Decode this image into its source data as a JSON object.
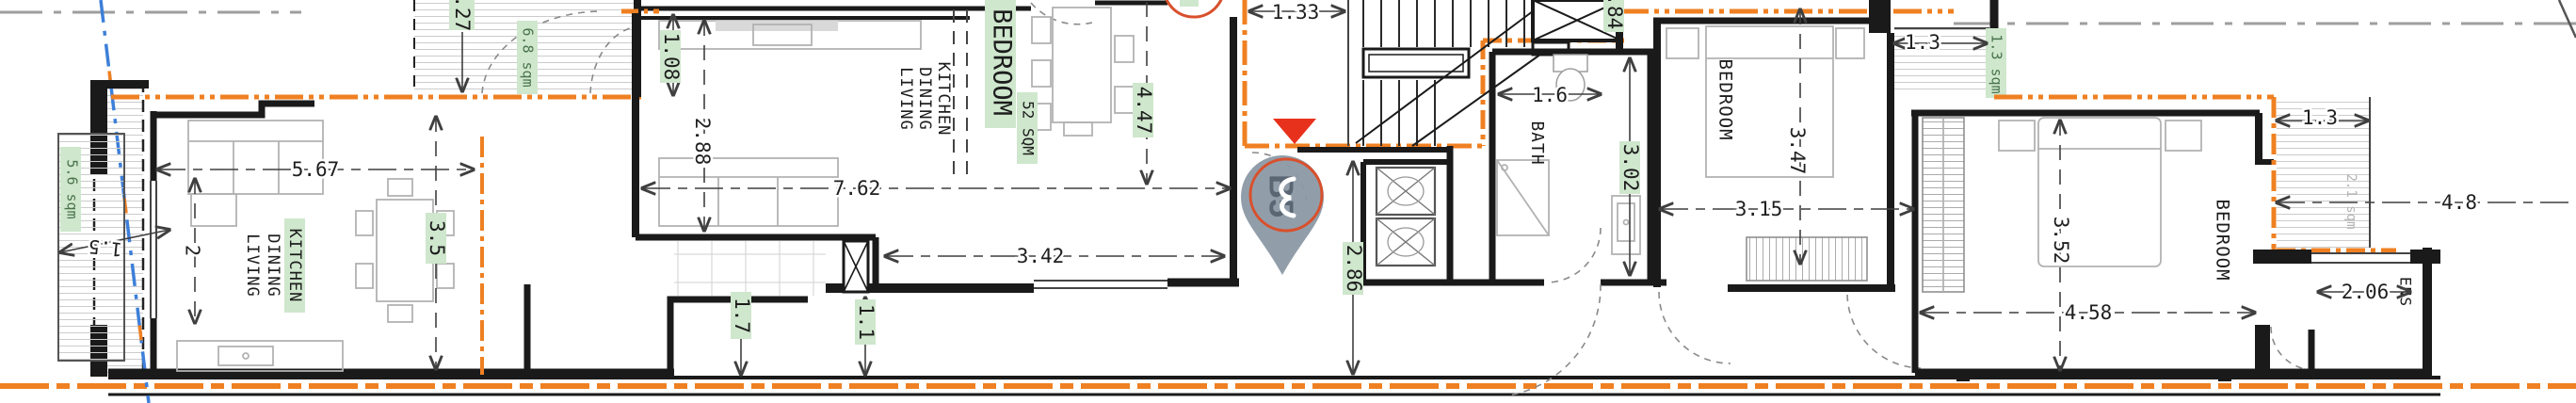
{
  "plan": {
    "pin_label": "B5",
    "rooms": {
      "u1_kitchen": "KITCHEN",
      "u1_dining": "DINING",
      "u1_living": "LIVING",
      "u2_kitchen": "KITCHEN",
      "u2_dining": "DINING",
      "u2_living": "LIVING",
      "u2_bedroom": "BEDROOM",
      "u2_bedroom_area": "52 SQM",
      "bath": "BATH",
      "bedroom_mid": "BEDROOM",
      "bedroom_right": "BEDROOM",
      "ensuite": "ENS"
    },
    "areas": {
      "west_balcony": "5.6 sqm",
      "top_balcony": "6.8 sqm",
      "small_balcony": "1.3 sqm",
      "east_balcony": "2.1 sqm"
    },
    "dims": {
      "d_5_67": "5.67",
      "d_3_5": "3.5",
      "d_1_5": "1.5",
      "d_2": "2",
      "d_2_27": "2.27",
      "d_1_08": "1.08",
      "d_2_88": "2.88",
      "d_7_62": "7.62",
      "d_3_42": "3.42",
      "d_4_47": "4.47",
      "d_1_7": "1.7",
      "d_1_1": "1.1",
      "d_1_33": "1.33",
      "d_1_84": "1.84",
      "d_1_6": "1.6",
      "d_3_02": "3.02",
      "d_2_86": "2.86",
      "d_3_47": "3.47",
      "d_3_15": "3.15",
      "d_1_3_top": "1.3",
      "d_1_3_right": "1.3",
      "d_4_8": "4.8",
      "d_3_52": "3.52",
      "d_4_58": "4.58",
      "d_2_06": "2.06"
    },
    "colors": {
      "boundary_orange": "#ef8022",
      "wall_black": "#1a1a1a",
      "highlight_green": "#cfe7cd",
      "marker_red": "#e8311c",
      "pin_gray": "#8d9aa7",
      "guide_blue": "#3d7fd9",
      "centerline_gray": "#9e9e9e"
    }
  }
}
